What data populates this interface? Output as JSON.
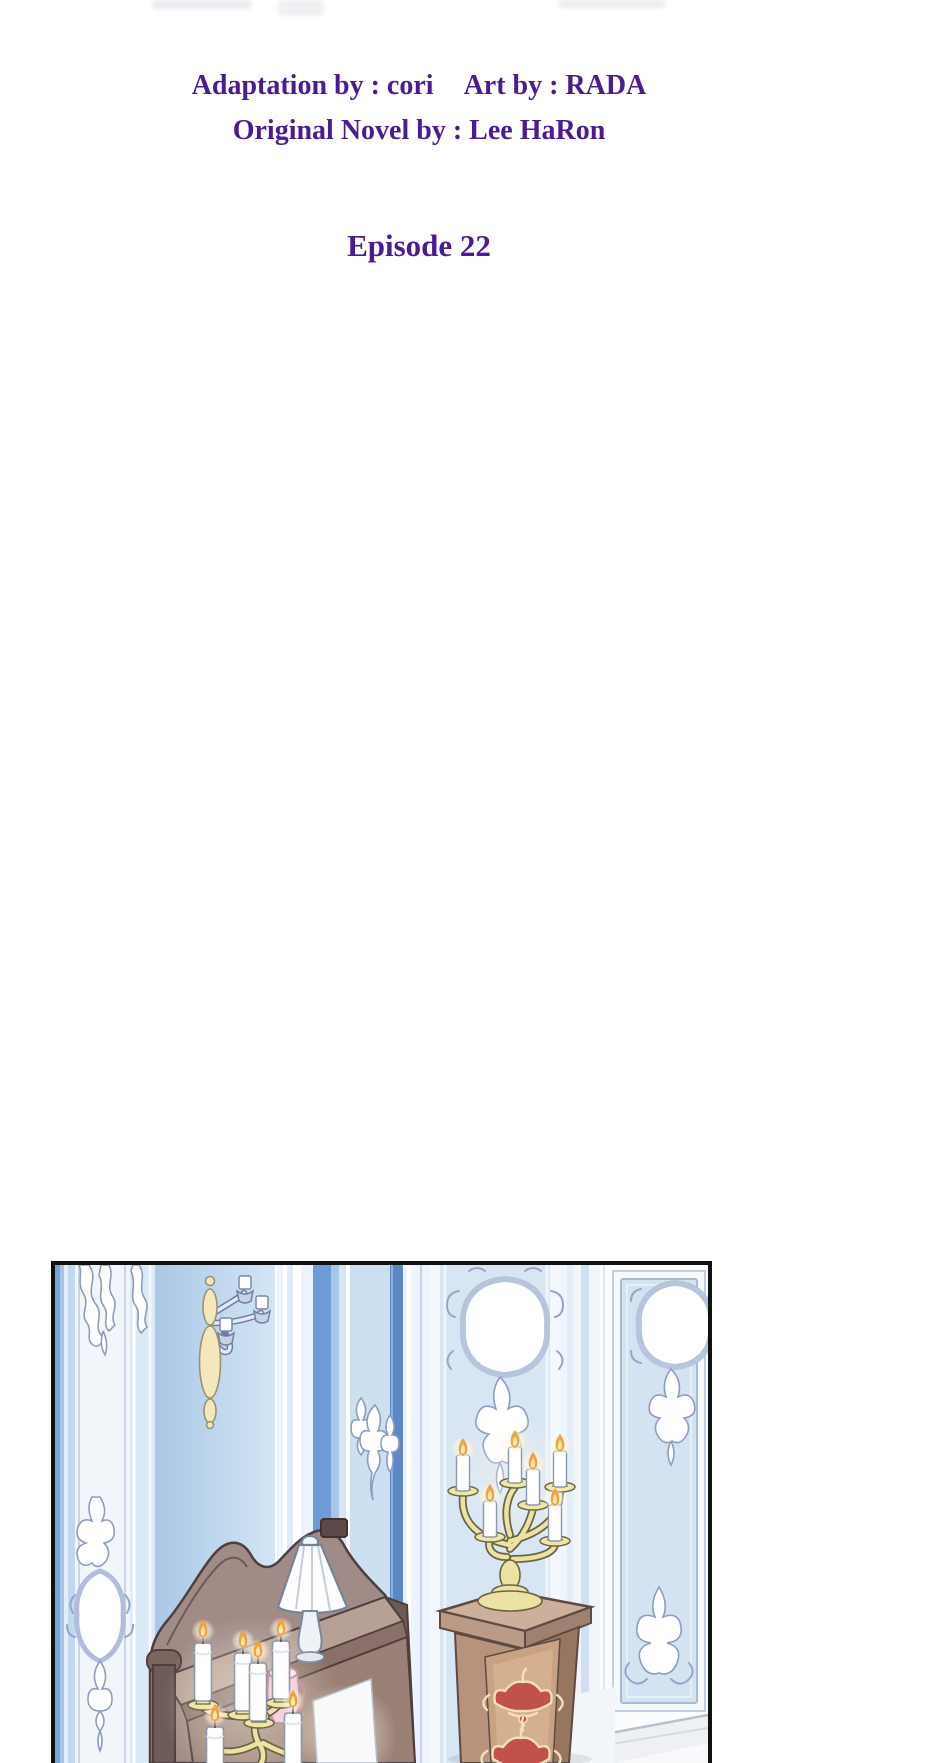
{
  "page": {
    "background_color": "#ffffff",
    "width": 940,
    "height": 1763
  },
  "header_credits": {
    "text_color": "#4a1b92",
    "adaptation": "Adaptation by : cori",
    "art": "Art by : RADA",
    "original_novel": "Original Novel by : Lee HaRon"
  },
  "episode": {
    "title": "Episode 22",
    "text_color": "#4a1b92"
  },
  "illustration_panel": {
    "border_color": "#111111",
    "alt": "Ornate pale-blue palace room with rococo wall panels and glowing oval cartouches, a cream wall sconce, a carved wooden cabinet topped by a white pleated lamp, golden candelabras with lit white candles, and a wooden pedestal decorated with red crown emblems",
    "colors": {
      "wall_blue": "#c6dbef",
      "accent_blue": "#6f9cd6",
      "deep_stripe_blue": "#5d88c5",
      "ornament_silver": "#97a6c8",
      "candelabra_gold": "#efe5a9",
      "wood_brown": "#9b8076",
      "pedestal_brown": "#b7937e",
      "crown_red": "#c1514b",
      "flame_orange": "#f2a23c",
      "lamp_white": "#fdfdfe"
    }
  }
}
